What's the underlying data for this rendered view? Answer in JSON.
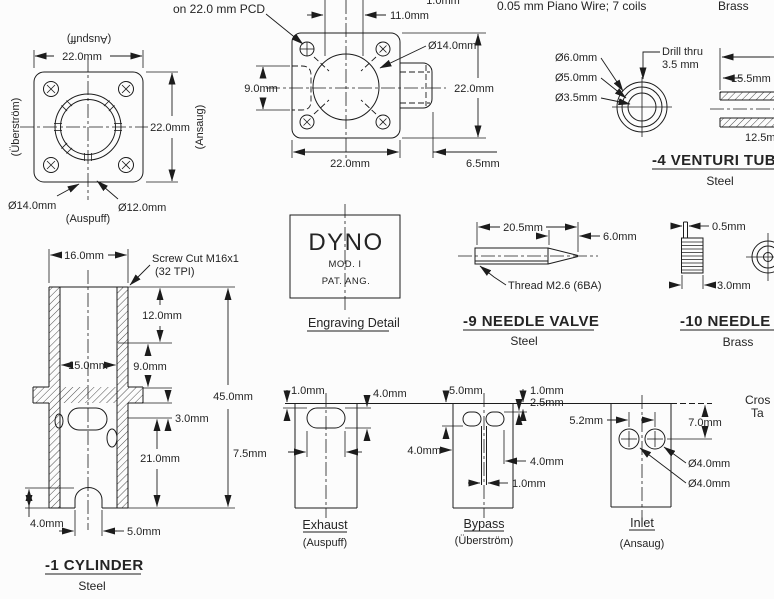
{
  "notes": {
    "pcd": "on 22.0 mm PCD",
    "piano_wire": "0.05 mm Piano Wire; 7 coils",
    "brass_top": "Brass"
  },
  "flange_end": {
    "dim_top": "22.0mm",
    "dim_right": "22.0mm",
    "label_top": "(Auspuff)",
    "label_left": "(Überström)",
    "label_right": "(Ansaug)",
    "dia_outer": "Ø14.0mm",
    "dia_inner": "Ø12.0mm",
    "label_bottom": "(Auspuff)"
  },
  "flange_front": {
    "dim_top_clipped": "1.0mm",
    "dim_11": "11.0mm",
    "dim_9": "9.0mm",
    "dim_width": "22.0mm",
    "dim_height": "22.0mm",
    "dim_6_5": "6.5mm",
    "dia_14": "Ø14.0mm"
  },
  "venturi": {
    "dia_6": "Ø6.0mm",
    "dia_5": "Ø5.0mm",
    "dia_3_5": "Ø3.5mm",
    "drill_1": "Drill thru",
    "drill_2": "3.5 mm",
    "dim_15_5": "15.5mm",
    "dim_12_5": "12.5mm",
    "title": "-4  VENTURI TUBE",
    "material": "Steel"
  },
  "engraving": {
    "brand": "DYNO",
    "mod": "MOD. I",
    "pat": "PAT. ANG.",
    "caption": "Engraving Detail"
  },
  "needle_valve": {
    "dim_20_5": "20.5mm",
    "dim_6": "6.0mm",
    "thread": "Thread M2.6 (6BA)",
    "title": "-9  NEEDLE VALVE",
    "material": "Steel"
  },
  "needle_knob": {
    "dim_0_5": "0.5mm",
    "dim_3": "3.0mm",
    "title": "-10  NEEDLE KNOB",
    "material": "Brass"
  },
  "cylinder": {
    "dim_16": "16.0mm",
    "screw_1": "Screw Cut M16x1",
    "screw_2": "(32 TPI)",
    "dim_12": "12.0mm",
    "dim_15": "15.0mm",
    "dim_9": "9.0mm",
    "dim_3": "3.0mm",
    "dim_21": "21.0mm",
    "dim_45": "45.0mm",
    "dim_4": "4.0mm",
    "dim_5": "5.0mm",
    "title": "-1  CYLINDER",
    "material": "Steel"
  },
  "exhaust": {
    "dim_1": "1.0mm",
    "dim_4": "4.0mm",
    "dim_7_5": "7.5mm",
    "title": "Exhaust",
    "subtitle": "(Auspuff)"
  },
  "bypass": {
    "dim_5": "5.0mm",
    "dim_1_top": "1.0mm",
    "dim_2_5": "2.5mm",
    "dim_4_left": "4.0mm",
    "dim_4_right": "4.0mm",
    "dim_1_bottom": "1.0mm",
    "title": "Bypass",
    "subtitle": "(Überström)"
  },
  "inlet": {
    "dim_5_2": "5.2mm",
    "dim_7": "7.0mm",
    "dia_a": "Ø4.0mm",
    "dia_b": "Ø4.0mm",
    "title": "Inlet",
    "subtitle": "(Ansaug)"
  },
  "fragments": {
    "line1": "Cros",
    "line2": "Ta"
  }
}
